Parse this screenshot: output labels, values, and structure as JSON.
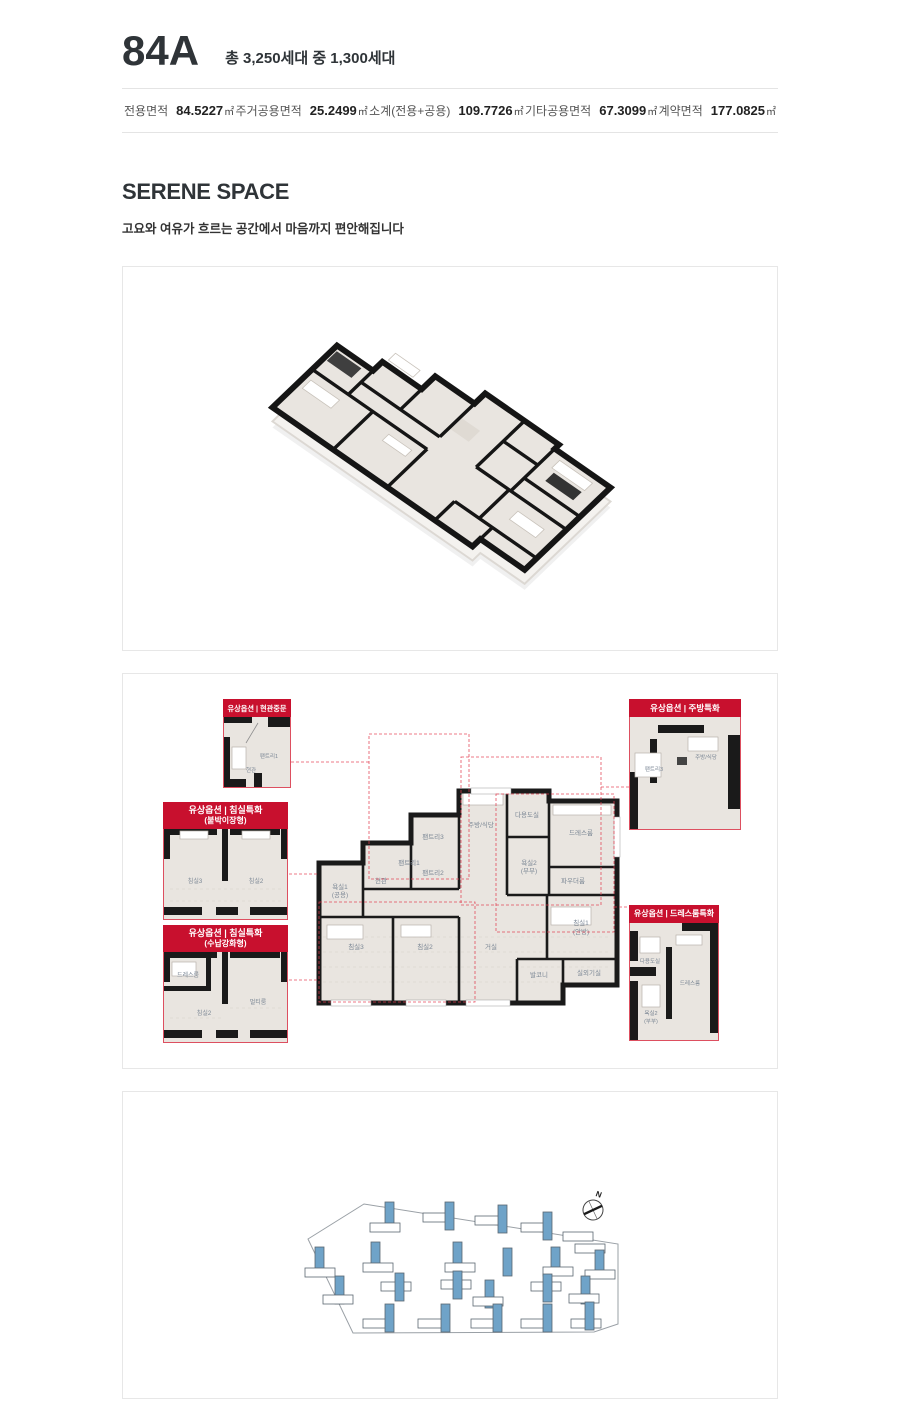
{
  "header": {
    "title": "84A",
    "subtitle": "총 3,250세대 중 1,300세대"
  },
  "specs": [
    {
      "label": "전용면적",
      "value": "84.5227",
      "unit": "㎡"
    },
    {
      "label": "주거공용면적",
      "value": "25.2499",
      "unit": "㎡"
    },
    {
      "label": "소계(전용+공용)",
      "value": "109.7726",
      "unit": "㎡"
    },
    {
      "label": "기타공용면적",
      "value": "67.3099",
      "unit": "㎡"
    },
    {
      "label": "계약면적",
      "value": "177.0825",
      "unit": "㎡"
    }
  ],
  "serene": {
    "heading": "SERENE SPACE",
    "description": "고요와 여유가 흐르는 공간에서 마음까지 편안해집니다"
  },
  "plan": {
    "rooms": {
      "entrance": "현관",
      "pantry1": "팬트리1",
      "pantry2": "팬트리2",
      "pantry3": "팬트리3",
      "bath1": "욕실1",
      "bath1_note": "(공용)",
      "kitchen": "주방/식당",
      "utility": "다용도실",
      "dressroom": "드레스룸",
      "bath2": "욕실2",
      "bath2_note": "(부부)",
      "powder": "파우더룸",
      "bed3": "침실3",
      "bed2": "침실2",
      "living": "거실",
      "bed1": "침실1",
      "bed1_note": "(안방)",
      "balcony": "발코니",
      "outdoor": "실외기실"
    }
  },
  "callouts": [
    {
      "title": "유상옵션 | 현관중문",
      "subtitle": "",
      "rooms": [
        "팬트리1",
        "현관"
      ]
    },
    {
      "title": "유상옵션 | 주방특화",
      "subtitle": "",
      "rooms": [
        "팬트리3",
        "주방/식당"
      ]
    },
    {
      "title": "유상옵션 | 침실특화",
      "subtitle": "(붙박이장형)",
      "rooms": [
        "침실3",
        "침실2"
      ]
    },
    {
      "title": "유상옵션 | 침실특화",
      "subtitle": "(수납강화형)",
      "rooms": [
        "드레스룸",
        "침실2",
        "멀티룸"
      ]
    },
    {
      "title": "유상옵션 | 드레스룸특화",
      "subtitle": "",
      "rooms": [
        "다용도실",
        "드레스룸",
        "욕실2",
        "(부부)"
      ]
    }
  ],
  "siteplan": {
    "compass": "N",
    "boundary": "185,147 241,112 495,152 495,232 471,240 230,241",
    "buildings": [
      [
        262,
        110,
        "v",
        "b"
      ],
      [
        247,
        131,
        "h",
        "w"
      ],
      [
        300,
        121,
        "h",
        "w"
      ],
      [
        322,
        110,
        "v",
        "b"
      ],
      [
        352,
        124,
        "h",
        "w"
      ],
      [
        375,
        113,
        "v",
        "b"
      ],
      [
        398,
        131,
        "h",
        "w"
      ],
      [
        420,
        120,
        "v",
        "b"
      ],
      [
        440,
        140,
        "h",
        "w"
      ],
      [
        452,
        152,
        "h",
        "w"
      ],
      [
        192,
        155,
        "v",
        "b"
      ],
      [
        182,
        176,
        "h",
        "w"
      ],
      [
        248,
        150,
        "v",
        "b"
      ],
      [
        240,
        171,
        "h",
        "w"
      ],
      [
        330,
        150,
        "v",
        "b"
      ],
      [
        322,
        171,
        "h",
        "w"
      ],
      [
        380,
        156,
        "v",
        "b"
      ],
      [
        428,
        155,
        "v",
        "b"
      ],
      [
        420,
        175,
        "h",
        "w"
      ],
      [
        472,
        158,
        "v",
        "b"
      ],
      [
        462,
        178,
        "h",
        "w"
      ],
      [
        212,
        184,
        "v",
        "b"
      ],
      [
        200,
        203,
        "h",
        "w"
      ],
      [
        258,
        190,
        "h",
        "w"
      ],
      [
        272,
        181,
        "v",
        "b"
      ],
      [
        318,
        188,
        "h",
        "w"
      ],
      [
        330,
        179,
        "v",
        "b"
      ],
      [
        362,
        188,
        "v",
        "b"
      ],
      [
        350,
        205,
        "h",
        "w"
      ],
      [
        408,
        190,
        "h",
        "w"
      ],
      [
        420,
        182,
        "v",
        "b"
      ],
      [
        458,
        184,
        "v",
        "b"
      ],
      [
        446,
        202,
        "h",
        "w"
      ],
      [
        240,
        227,
        "h",
        "w"
      ],
      [
        262,
        212,
        "v",
        "b"
      ],
      [
        295,
        227,
        "h",
        "w"
      ],
      [
        318,
        212,
        "v",
        "b"
      ],
      [
        348,
        227,
        "h",
        "w"
      ],
      [
        370,
        212,
        "v",
        "b"
      ],
      [
        398,
        227,
        "h",
        "w"
      ],
      [
        420,
        212,
        "v",
        "b"
      ],
      [
        448,
        227,
        "h",
        "w"
      ],
      [
        462,
        210,
        "v",
        "b"
      ]
    ]
  },
  "colors": {
    "accent_red": "#C8102E",
    "callout_border": "#DD4F60",
    "dashed_red": "#E23B4E",
    "wall_black": "#1A1A1A",
    "floor_beige": "#E9E5E0",
    "building_blue": "#6FA3C8",
    "text_dark": "#2F3438",
    "border_gray": "#E7E7E7"
  }
}
